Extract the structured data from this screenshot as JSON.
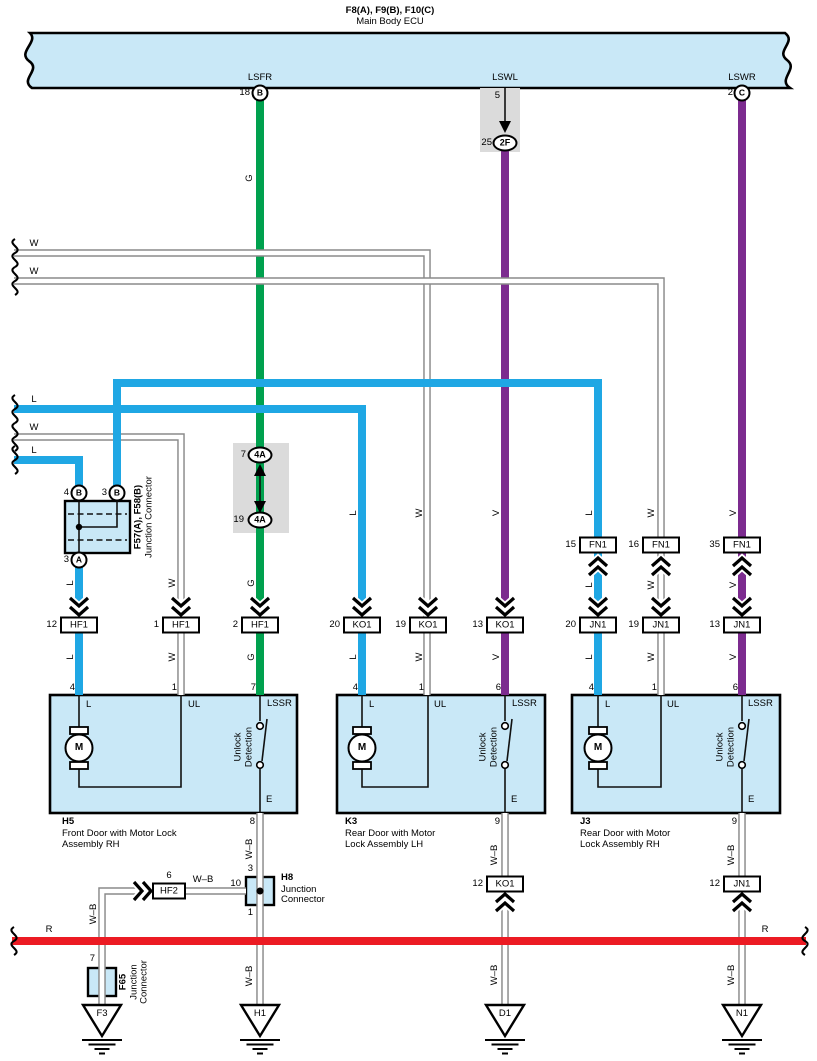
{
  "title": {
    "models": "F8(A), F9(B), F10(C)",
    "name": "Main Body ECU"
  },
  "ecu": {
    "lsfr": "LSFR",
    "lswl": "LSWL",
    "lswr": "LSWR",
    "lsfr_pin": "18",
    "lsfr_conn": "B",
    "lswl_pin": "5",
    "lswr_pin": "2",
    "lswr_conn": "C"
  },
  "wires": {
    "g": "G",
    "w": "W",
    "l": "L",
    "v": "V",
    "r": "R",
    "wb": "W–B"
  },
  "inline": {
    "c2f_pin": "25",
    "c2f": "2F",
    "c4a_top_pin": "7",
    "c4a": "4A",
    "c4a_bottom_pin": "19"
  },
  "f57": {
    "name": "F57(A), F58(B)",
    "type": "Junction Connector",
    "pin4": "4",
    "pin3": "3",
    "pin3a": "3",
    "b": "B",
    "a": "A"
  },
  "conn": {
    "hf1": "HF1",
    "ko1": "KO1",
    "jn1": "JN1",
    "fn1": "FN1",
    "hf2": "HF2",
    "hf2_pin": "6",
    "hf1_pins": [
      "12",
      "1",
      "2"
    ],
    "ko1_pins": [
      "20",
      "19",
      "13"
    ],
    "fn1_pins": [
      "15",
      "16",
      "35"
    ],
    "jn1_pins": [
      "20",
      "19",
      "13"
    ],
    "ko1_bottom_pin": "12",
    "jn1_bottom_pin": "12"
  },
  "boxes": {
    "h5": {
      "id": "H5",
      "desc1": "Front Door with Motor Lock",
      "desc2": "Assembly RH",
      "pin_l": "4",
      "pin_ul": "1",
      "pin_lssr": "7",
      "pin_e": "8"
    },
    "k3": {
      "id": "K3",
      "desc1": "Rear Door with Motor",
      "desc2": "Lock Assembly LH",
      "pin_l": "4",
      "pin_ul": "1",
      "pin_lssr": "6",
      "pin_e": "9"
    },
    "j3": {
      "id": "J3",
      "desc1": "Rear Door with Motor",
      "desc2": "Lock Assembly RH",
      "pin_l": "4",
      "pin_ul": "1",
      "pin_lssr": "6",
      "pin_e": "9"
    },
    "t_l": "L",
    "t_ul": "UL",
    "t_lssr": "LSSR",
    "t_e": "E",
    "motor": "M",
    "sw1": "Unlock",
    "sw2": "Detection"
  },
  "h8": {
    "id": "H8",
    "type1": "Junction",
    "type2": "Connector",
    "pin_top": "3",
    "pin_left": "10",
    "pin_bottom": "1"
  },
  "f65": {
    "id": "F65",
    "type1": "Junction",
    "type2": "Connector",
    "pin": "7"
  },
  "grounds": {
    "f3": "F3",
    "h1": "H1",
    "d1": "D1",
    "n1": "N1"
  },
  "colors": {
    "lightblue": "#C9E8F7",
    "blue": "#1FA7E4",
    "green": "#00A14E",
    "purple": "#7C2B8F",
    "red": "#EC1B23",
    "shade": "#DBDBDB",
    "wire_edge": "#8A8A8A"
  }
}
